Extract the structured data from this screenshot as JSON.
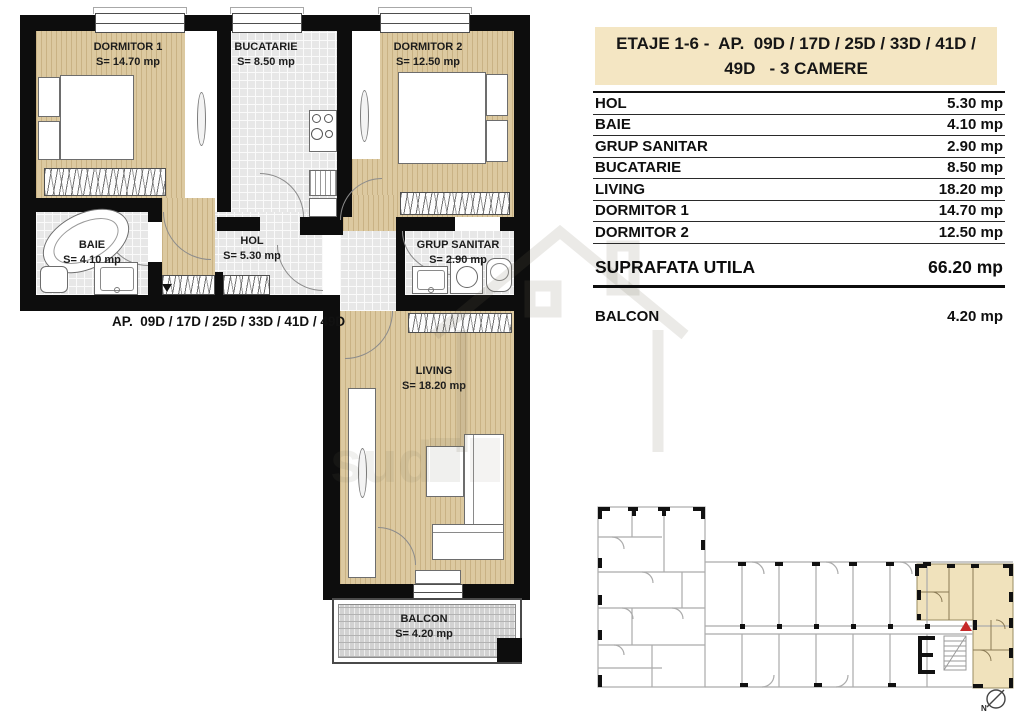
{
  "title_box": {
    "line1": "ETAJE 1-6 -  AP.  09D / 17D / 25D / 33D / 41D /",
    "line2": "49D   - 3 CAMERE"
  },
  "areas_table": {
    "rows": [
      {
        "label": "HOL",
        "value": "5.30 mp"
      },
      {
        "label": "BAIE",
        "value": "4.10 mp"
      },
      {
        "label": "GRUP SANITAR",
        "value": "2.90 mp"
      },
      {
        "label": "BUCATARIE",
        "value": "8.50 mp"
      },
      {
        "label": "LIVING",
        "value": "18.20 mp"
      },
      {
        "label": "DORMITOR 1",
        "value": "14.70 mp"
      },
      {
        "label": "DORMITOR 2",
        "value": "12.50 mp"
      }
    ]
  },
  "summary": {
    "label": "SUPRAFATA UTILA",
    "value": "66.20 mp"
  },
  "balcony_row": {
    "label": "BALCON",
    "value": "4.20 mp"
  },
  "plan": {
    "caption": "AP.  09D / 17D / 25D / 33D / 41D / 49D",
    "rooms": {
      "dormitor1": {
        "name": "DORMITOR 1",
        "area": "S= 14.70 mp"
      },
      "bucatarie": {
        "name": "BUCATARIE",
        "area": "S= 8.50 mp"
      },
      "dormitor2": {
        "name": "DORMITOR 2",
        "area": "S= 12.50 mp"
      },
      "baie": {
        "name": "BAIE",
        "area": "S= 4.10 mp"
      },
      "hol": {
        "name": "HOL",
        "area": "S= 5.30 mp"
      },
      "grup_sanitar": {
        "name": "GRUP SANITAR",
        "area": "S= 2.90 mp"
      },
      "living": {
        "name": "LIVING",
        "area": "S= 18.20 mp"
      },
      "balcon": {
        "name": "BALCON",
        "area": "S= 4.20 mp"
      }
    }
  },
  "keyplan": {
    "north_label": "N"
  },
  "colors": {
    "title_cream": "#f4e6c3",
    "keyplan_highlight_cream": "#f0e2bc",
    "wood_floor": "#dcc9a0",
    "tile_floor": "#e7e7e7",
    "wall_black": "#0d0d0d",
    "entrance_marker_red": "#c62828"
  }
}
